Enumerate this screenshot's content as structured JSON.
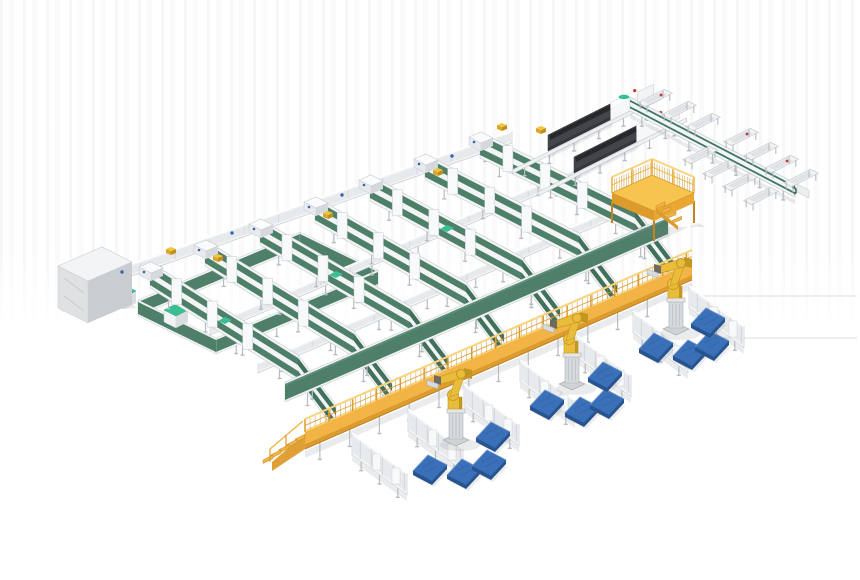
{
  "scene": {
    "width": 860,
    "height": 580,
    "background": "#ffffff",
    "description": "isometric 3d render of automated parcel sorting and palletizing line"
  },
  "colors": {
    "beltGreen": "#4e7f68",
    "beltGreenDark": "#41705d",
    "beltGreenDeep": "#38614f",
    "teal": "#38c093",
    "convWhite": "#f2f4f5",
    "convInner": "#e7eaec",
    "frameEdge": "#c7ccd1",
    "rollerLine": "#cdd2d6",
    "legGray": "#b6bcc2",
    "plateWhite": "#f8f9fa",
    "yellowMain": "#f2b445",
    "yellowDark": "#dd9b2c",
    "yellowDeep": "#c58320",
    "yellowLight": "#f9d27c",
    "robotYellow": "#e9bd3b",
    "robotDark": "#c2971f",
    "robotJoint": "#6f6a60",
    "pedestal": "#d7dadd",
    "pedestalDark": "#aab0b5",
    "palletTop": "#3a70b8",
    "palletSide": "#27538f",
    "palletHi": "#7099ce",
    "machineDark": "#42464b",
    "machineTop": "#26282b",
    "machineWhite": "#f6f7f8",
    "redDot": "#c23a2e",
    "blueDot": "#3a62b0",
    "cabinetTop": "#f3f4f6",
    "cabinetFront": "#dfe1e3",
    "cabinetSide": "#c9ccd0",
    "floorLine": "#dcdedf",
    "shadow": "rgba(125,130,135,0.16)"
  },
  "lanes": [
    {
      "head": [
        150,
        275
      ],
      "knee": [
        298,
        368
      ],
      "end": [
        336,
        418
      ]
    },
    {
      "head": [
        205,
        253
      ],
      "knee": [
        354,
        344
      ],
      "end": [
        392,
        394
      ]
    },
    {
      "head": [
        260,
        232
      ],
      "knee": [
        410,
        319
      ],
      "end": [
        448,
        369
      ]
    },
    {
      "head": [
        315,
        210
      ],
      "knee": [
        466,
        295
      ],
      "end": [
        504,
        345
      ]
    },
    {
      "head": [
        370,
        188
      ],
      "knee": [
        522,
        270
      ],
      "end": [
        560,
        320
      ]
    },
    {
      "head": [
        425,
        167
      ],
      "knee": [
        579,
        246
      ],
      "end": [
        617,
        296
      ]
    },
    {
      "head": [
        480,
        145
      ],
      "knee": [
        635,
        221
      ],
      "end": [
        673,
        271
      ]
    }
  ],
  "crossLines": [
    {
      "from": [
        80,
        288
      ],
      "to": [
        512,
        137
      ],
      "w": 6
    },
    {
      "from": [
        210,
        330
      ],
      "to": [
        580,
        172
      ],
      "w": 5
    },
    {
      "from": [
        258,
        368
      ],
      "to": [
        645,
        200
      ],
      "w": 5
    }
  ],
  "collectorBelt": {
    "from": [
      285,
      392
    ],
    "to": [
      668,
      226
    ],
    "w": 8
  },
  "loop": {
    "outer": [
      [
        138,
        308
      ],
      [
        300,
        240
      ],
      [
        378,
        278
      ],
      [
        216,
        346
      ]
    ],
    "w": 6
  },
  "loopBoxes": [
    [
      122,
      296
    ],
    [
      174,
      315
    ]
  ],
  "cabinet": {
    "top": [
      [
        58,
        266
      ],
      [
        102,
        247
      ],
      [
        132,
        262
      ],
      [
        88,
        281
      ]
    ],
    "h": 42
  },
  "machines": [
    {
      "start": [
        548,
        143
      ]
    },
    {
      "start": [
        574,
        165
      ]
    }
  ],
  "platform": {
    "deck": [
      [
        612,
        193
      ],
      [
        652,
        175
      ],
      [
        694,
        193
      ],
      [
        654,
        211
      ]
    ],
    "legH": 22,
    "railH": 16
  },
  "walkway": {
    "from": [
      305,
      432
    ],
    "to": [
      692,
      263
    ],
    "panelH": 12,
    "railH": 13
  },
  "spurs": [
    {
      "from": [
        352,
        444
      ],
      "to": [
        407,
        484
      ]
    },
    {
      "from": [
        408,
        420
      ],
      "to": [
        463,
        460
      ]
    },
    {
      "from": [
        464,
        395
      ],
      "to": [
        519,
        435
      ]
    },
    {
      "from": [
        520,
        371
      ],
      "to": [
        575,
        411
      ]
    },
    {
      "from": [
        576,
        346
      ],
      "to": [
        631,
        386
      ]
    },
    {
      "from": [
        633,
        322
      ],
      "to": [
        688,
        362
      ]
    },
    {
      "from": [
        689,
        297
      ],
      "to": [
        744,
        337
      ]
    }
  ],
  "robots": [
    [
      456,
      441
    ],
    [
      572,
      385
    ],
    [
      676,
      330
    ]
  ],
  "pallets": [
    [
      430,
      468
    ],
    [
      464,
      472
    ],
    [
      489,
      463
    ],
    [
      493,
      435
    ],
    [
      547,
      403
    ],
    [
      582,
      410
    ],
    [
      607,
      402
    ],
    [
      605,
      375
    ],
    [
      656,
      346
    ],
    [
      690,
      353
    ],
    [
      712,
      344
    ],
    [
      708,
      321
    ]
  ],
  "rightLine": {
    "from": [
      630,
      104
    ],
    "to": [
      795,
      190
    ],
    "w": 7
  },
  "tablesUpper": [
    [
      741,
      137
    ],
    [
      761,
      151
    ],
    [
      781,
      164
    ],
    [
      801,
      178
    ]
  ],
  "tablesLower": [
    [
      700,
      155
    ],
    [
      720,
      169
    ],
    [
      740,
      182
    ],
    [
      761,
      196
    ]
  ],
  "tablesTop": [
    [
      655,
      98
    ],
    [
      679,
      110
    ],
    [
      703,
      122
    ]
  ],
  "floorLines": [
    [
      700,
      296,
      857,
      296
    ],
    [
      718,
      338,
      857,
      338
    ]
  ],
  "parcelsYellow": [
    [
      170,
      252
    ],
    [
      217,
      259
    ],
    [
      327,
      216
    ],
    [
      437,
      173
    ],
    [
      501,
      128
    ],
    [
      540,
      131
    ]
  ],
  "blueDots": [
    [
      122,
      272
    ],
    [
      232,
      233
    ],
    [
      342,
      195
    ],
    [
      452,
      156
    ]
  ],
  "tealCaps": [
    [
      224,
      318
    ],
    [
      335,
      272
    ],
    [
      446,
      226
    ]
  ]
}
